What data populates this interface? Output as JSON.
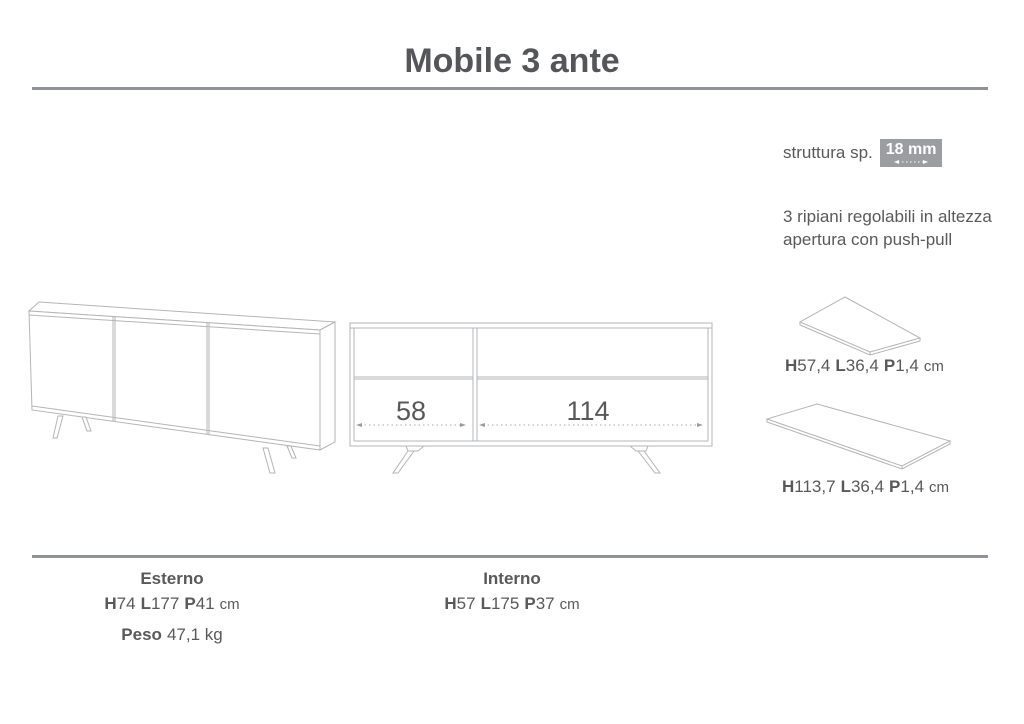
{
  "title": "Mobile 3 ante",
  "labels": {
    "H": "H",
    "L": "L",
    "P": "P",
    "cm": "cm"
  },
  "notes": {
    "structure_label": "struttura sp.",
    "structure_value": "18 mm",
    "features": [
      "3 ripiani regolabili in altezza",
      "apertura con push-pull"
    ]
  },
  "shelves": {
    "small": {
      "H": "57,4",
      "L": "36,4",
      "P": "1,4"
    },
    "large": {
      "H": "113,7",
      "L": "36,4",
      "P": "1,4"
    }
  },
  "front_view": {
    "left_width": "58",
    "right_width": "114"
  },
  "external": {
    "title": "Esterno",
    "H": "74",
    "L": "177",
    "P": "41",
    "weight_label": "Peso",
    "weight_value": "47,1 kg"
  },
  "internal": {
    "title": "Interno",
    "H": "57",
    "L": "175",
    "P": "37"
  },
  "colors": {
    "text": "#58595b",
    "line_art": "#b3b5b7",
    "rule": "#8f9398",
    "value_box_bg": "#9b9ea1",
    "value_box_text": "#ffffff"
  }
}
